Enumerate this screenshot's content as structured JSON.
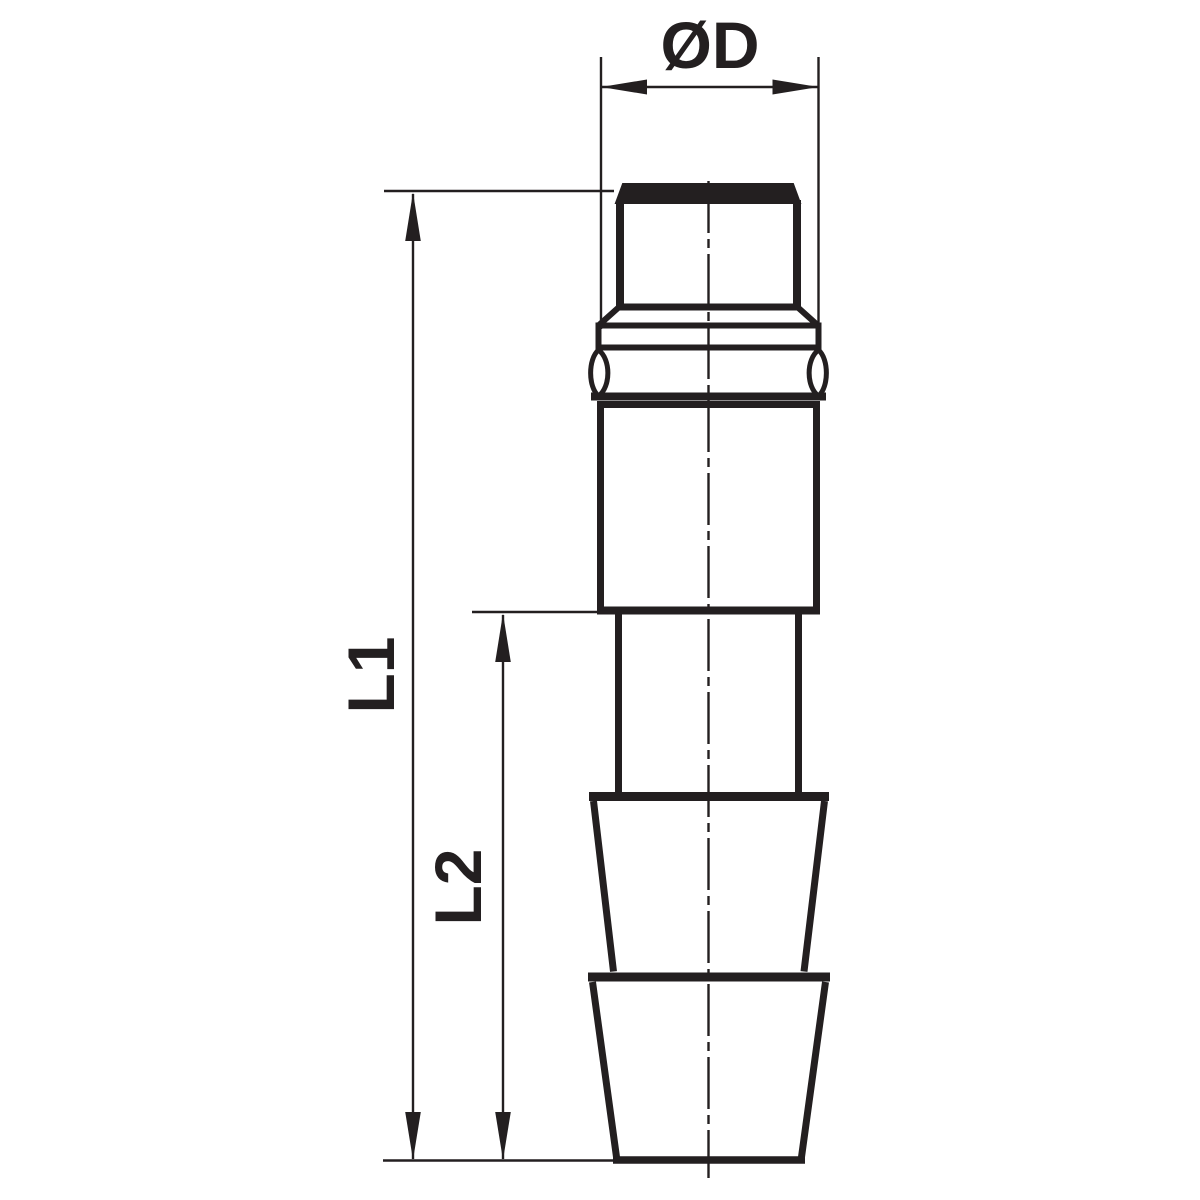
{
  "drawing": {
    "labels": {
      "diameter": "ØD",
      "length_overall": "L1",
      "length_tail": "L2"
    },
    "colors": {
      "line": "#231f20",
      "background": "#ffffff"
    }
  }
}
